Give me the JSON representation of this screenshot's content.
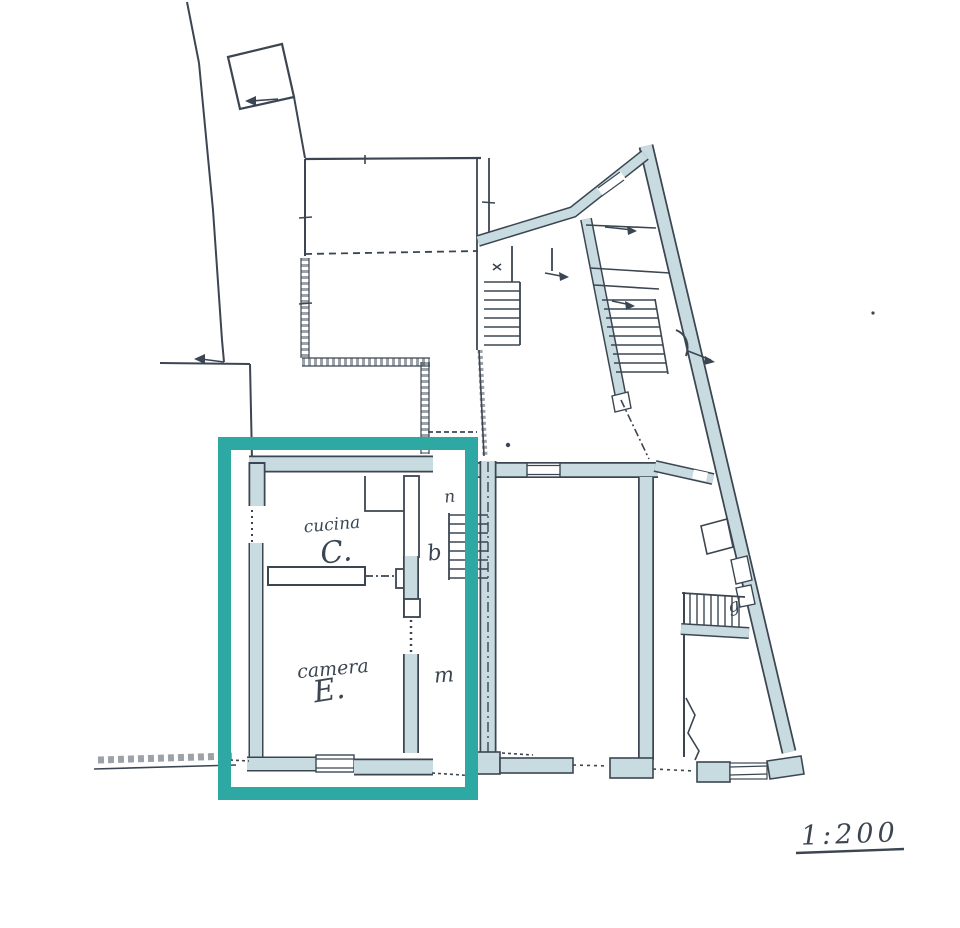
{
  "plan": {
    "rooms": [
      {
        "name": "cucina",
        "letter": "C."
      },
      {
        "name": "camera",
        "letter": "E."
      }
    ],
    "marks": {
      "n": "n",
      "b": "b",
      "m": "m",
      "g": "g"
    },
    "scale_label": "1:200"
  },
  "colors": {
    "ink": "#3b4652",
    "wall_fill": "#c8dbe0",
    "highlight": "#2ea8a2",
    "paper": "#ffffff"
  }
}
